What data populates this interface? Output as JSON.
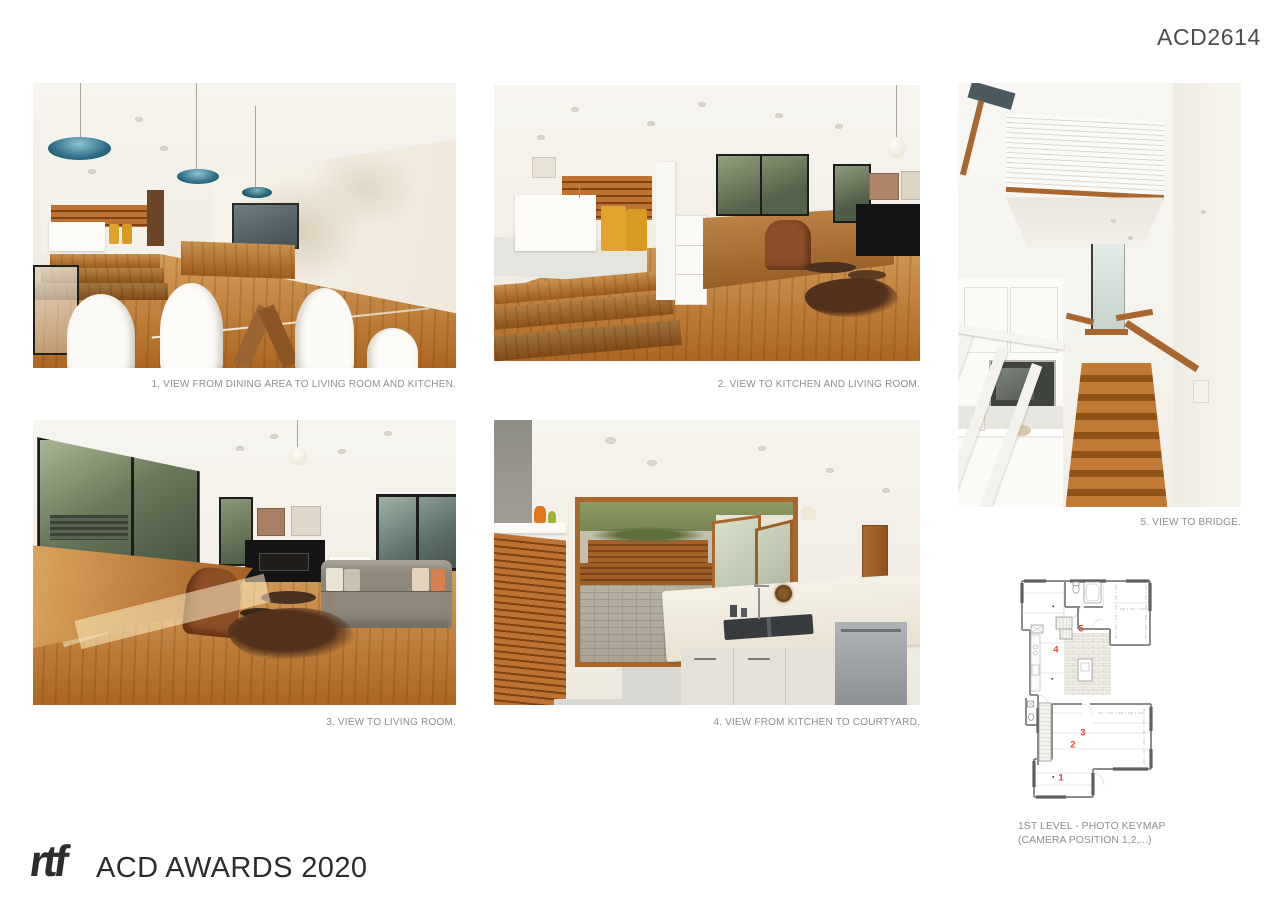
{
  "board": {
    "code": "ACD2614",
    "logo_text": "rtf",
    "footer_title": "ACD AWARDS 2020"
  },
  "photos": [
    {
      "caption": "1. VIEW FROM DINING AREA TO LIVING ROOM AND KITCHEN."
    },
    {
      "caption": "2. VIEW TO KITCHEN AND LIVING ROOM."
    },
    {
      "caption": "3. VIEW TO LIVING ROOM."
    },
    {
      "caption": "4. VIEW FROM KITCHEN TO COURTYARD."
    },
    {
      "caption": "5. VIEW TO BRIDGE."
    }
  ],
  "keymap": {
    "caption_line1": "1ST LEVEL - PHOTO KEYMAP",
    "caption_line2": "(CAMERA POSITION 1,2,...)",
    "marker_color": "#e8453c",
    "markers": [
      {
        "label": "1",
        "x": 31.9,
        "y": 90.3
      },
      {
        "label": "2",
        "x": 40.7,
        "y": 75.8
      },
      {
        "label": "3",
        "x": 48.1,
        "y": 70.5
      },
      {
        "label": "4",
        "x": 28.1,
        "y": 33.9
      },
      {
        "label": "5",
        "x": 46.7,
        "y": 24.7
      }
    ]
  }
}
